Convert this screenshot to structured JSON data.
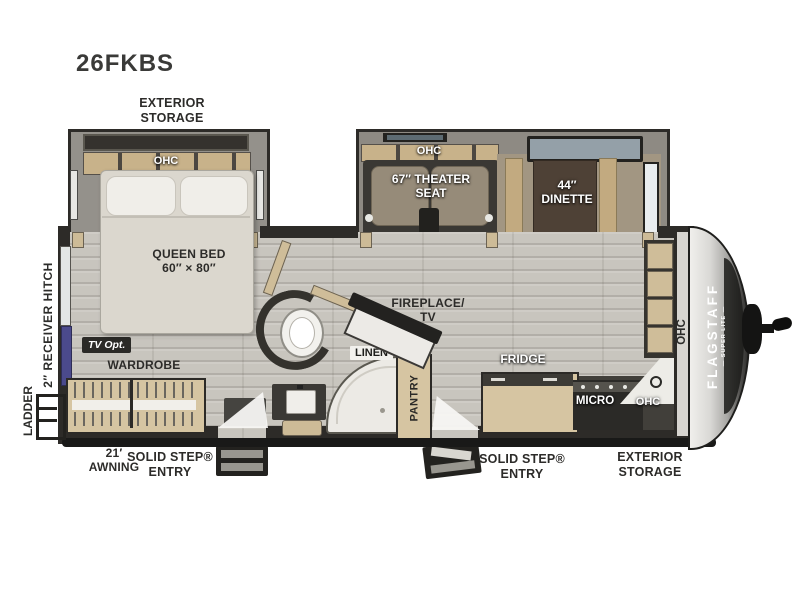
{
  "model": "26FKBS",
  "colors": {
    "wall": "#2d2b28",
    "floor": "#c8c5be",
    "cabinet": "#d6c5a2",
    "slide_floor": "#94918b",
    "badge_bg": "#2b2a27",
    "tv_accent": "#4b4a8c",
    "mattress": "#dbd7ce"
  },
  "labels": {
    "exterior_storage_rear": "EXTERIOR\nSTORAGE",
    "bedroom_ohc": "OHC",
    "queen_bed": "QUEEN BED\n60″ × 80″",
    "tv_opt": "TV Opt.",
    "wardrobe": "WARDROBE",
    "receiver_hitch": "2″ RECEIVER HITCH",
    "ladder": "LADDER",
    "awning": "21′\nAWNING",
    "entry_rear": "SOLID STEP®\nENTRY",
    "entry_front": "SOLID STEP®\nENTRY",
    "exterior_storage_front": "EXTERIOR\nSTORAGE",
    "living_ohc": "OHC",
    "theater_seat": "67″ THEATER\nSEAT",
    "hide_a_bed_opt": "68″ Hide-A-Bed Opt.",
    "dinette": "44″\nDINETTE",
    "table_chairs_opt": "Table & Chairs Opt.",
    "fireplace_tv": "FIREPLACE/\nTV",
    "linen": "LINEN",
    "pantry": "PANTRY",
    "fridge": "FRIDGE",
    "micro": "MICRO",
    "kitchen_ohc": "OHC",
    "front_wall_ohc": "OHC",
    "brand": "FLAGSTAFF",
    "brand_sub": "— SUPER LITE —"
  }
}
